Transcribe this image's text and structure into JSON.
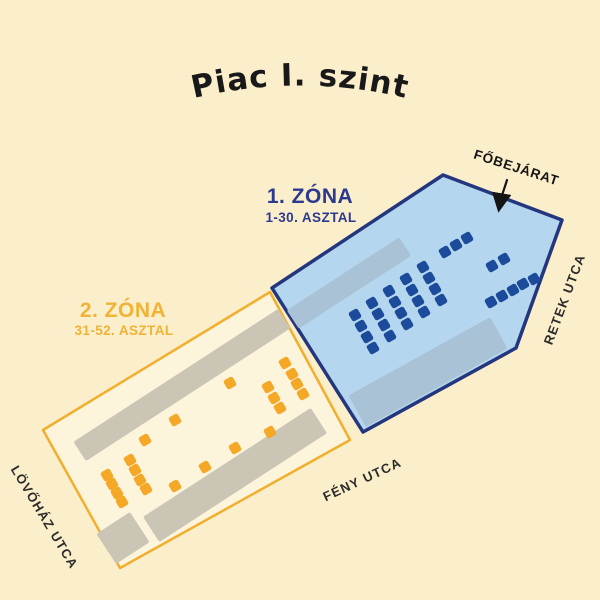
{
  "title": "Piac I. szint",
  "zone1_label": {
    "name": "1. ZÓNA",
    "range": "1-30. ASZTAL"
  },
  "zone2_label": {
    "name": "2. ZÓNA",
    "range": "31-52. ASZTAL"
  },
  "entrance_label": "FŐBEJÁRAT",
  "streets": {
    "right": "RETEK UTCA",
    "bottom": "FÉNY UTCA",
    "left": "LÖVŐHÁZ UTCA"
  },
  "colors": {
    "background": "#fbeecb",
    "zone1_fill": "#b4d7ef",
    "zone1_stroke": "#24367d",
    "zone1_table": "#1d4b9b",
    "zone1_stall": "#aac2d5",
    "zone2_fill": "#fdf4dc",
    "zone2_stroke": "#f2ae2e",
    "zone2_table": "#f5a726",
    "zone2_stall": "#cbc5b6",
    "title_text": "#191919",
    "zone1_text": "#2b3a8f",
    "zone2_text": "#f2b233",
    "street_text": "#2b2b2b",
    "arrow": "#151515"
  },
  "map": {
    "table_angle": -30,
    "table_size": 10.5,
    "zone1": {
      "fill": "#b4d7ef",
      "stroke": "#24367d",
      "stroke_width": 3.5,
      "outline": [
        [
          272,
          288
        ],
        [
          443,
          175
        ],
        [
          562,
          220
        ],
        [
          516,
          348
        ],
        [
          363,
          432
        ]
      ],
      "table_color": "#1d4b9b",
      "table_count": 30,
      "tables": [
        [
          355,
          315
        ],
        [
          361,
          326
        ],
        [
          367,
          337
        ],
        [
          373,
          348
        ],
        [
          372,
          303
        ],
        [
          378,
          314
        ],
        [
          384,
          325
        ],
        [
          390,
          336
        ],
        [
          389,
          291
        ],
        [
          395,
          302
        ],
        [
          401,
          313
        ],
        [
          407,
          324
        ],
        [
          406,
          279
        ],
        [
          412,
          290
        ],
        [
          418,
          301
        ],
        [
          424,
          312
        ],
        [
          423,
          267
        ],
        [
          429,
          278
        ],
        [
          435,
          289
        ],
        [
          441,
          300
        ],
        [
          445,
          252
        ],
        [
          456,
          245
        ],
        [
          467,
          238
        ],
        [
          492,
          266
        ],
        [
          504,
          259
        ],
        [
          491,
          302
        ],
        [
          502,
          296
        ],
        [
          513,
          290
        ],
        [
          523,
          284
        ],
        [
          534,
          279
        ]
      ]
    },
    "zone2": {
      "fill": "#fdf4dc",
      "stroke": "#f2ae2e",
      "stroke_width": 2.5,
      "outline": [
        [
          270,
          292
        ],
        [
          43,
          430
        ],
        [
          120,
          568
        ],
        [
          350,
          440
        ]
      ],
      "table_color": "#f5a726",
      "table_count": 22,
      "tables": [
        [
          285,
          363
        ],
        [
          292,
          374
        ],
        [
          297,
          384
        ],
        [
          303,
          394
        ],
        [
          268,
          387
        ],
        [
          274,
          398
        ],
        [
          280,
          408
        ],
        [
          230,
          383
        ],
        [
          175,
          420
        ],
        [
          145,
          440
        ],
        [
          270,
          432
        ],
        [
          235,
          448
        ],
        [
          205,
          467
        ],
        [
          175,
          486
        ],
        [
          130,
          460
        ],
        [
          135,
          470
        ],
        [
          140,
          480
        ],
        [
          146,
          489
        ],
        [
          107,
          475
        ],
        [
          112,
          484
        ],
        [
          117,
          493
        ],
        [
          122,
          502
        ]
      ]
    },
    "stalls": [
      {
        "zone": "zone1",
        "cx": 349,
        "cy": 283,
        "w": 134,
        "h": 22,
        "angle": -33,
        "fill": "#aac2d5"
      },
      {
        "zone": "zone1",
        "cx": 428,
        "cy": 372,
        "w": 162,
        "h": 36,
        "angle": -29,
        "fill": "#aac2d5"
      },
      {
        "zone": "zone2",
        "cx": 182,
        "cy": 385,
        "w": 244,
        "h": 23,
        "angle": -33,
        "fill": "#cbc5b6"
      },
      {
        "zone": "zone2",
        "cx": 235,
        "cy": 475,
        "w": 200,
        "h": 30,
        "angle": -33,
        "fill": "#cbc5b6"
      },
      {
        "zone": "zone2",
        "cx": 123,
        "cy": 538,
        "w": 40,
        "h": 36,
        "angle": -33,
        "fill": "#cbc5b6"
      }
    ]
  }
}
